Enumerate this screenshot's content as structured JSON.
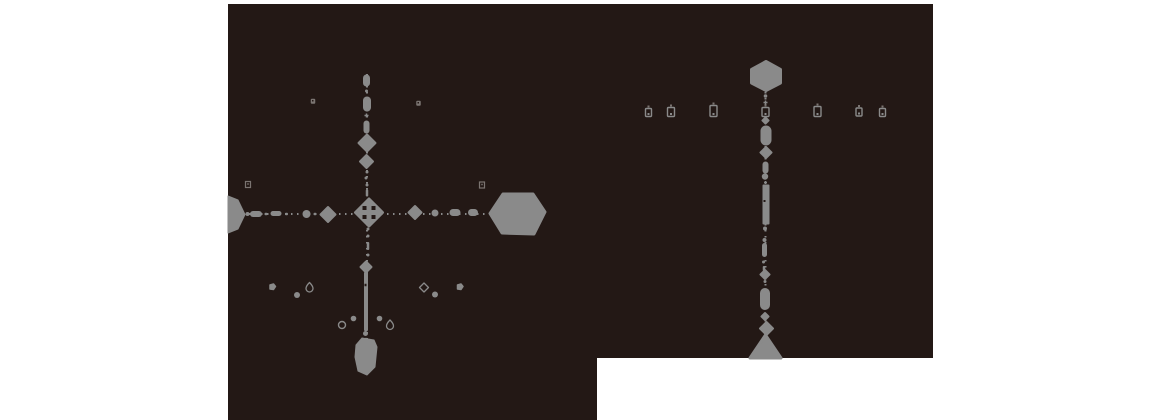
{
  "canvas": {
    "width": 1160,
    "height": 420
  },
  "colors": {
    "page_bg": "#ffffff",
    "map_bg": "#231815",
    "shape": "#8a8a8a",
    "shape_dim": "#7b7471",
    "hole": "#231815"
  },
  "map_region": {
    "name": "map-dark-region",
    "polygon": "228,4 933,4 933,358 597,358 597,420 228,420"
  },
  "dotted_paths": [
    {
      "name": "west-map-vertical-path",
      "x1": 367,
      "y1": 74,
      "x2": 367,
      "y2": 340
    },
    {
      "name": "west-map-horizontal-path",
      "x1": 231,
      "y1": 214,
      "x2": 492,
      "y2": 214
    },
    {
      "name": "east-map-vertical-path",
      "x1": 765.5,
      "y1": 92,
      "x2": 765.5,
      "y2": 338
    }
  ],
  "west_map": {
    "shapes": [
      {
        "kind": "capsule",
        "name": "waypoint-capsule",
        "x": 366.5,
        "y": 80.5,
        "w": 7,
        "h": 12
      },
      {
        "kind": "dot",
        "x": 366.5,
        "y": 91,
        "r": 1.5
      },
      {
        "kind": "capsule",
        "name": "waypoint-capsule",
        "x": 367,
        "y": 104,
        "w": 8,
        "h": 15
      },
      {
        "kind": "plus",
        "x": 366.5,
        "y": 115.5,
        "s": 4
      },
      {
        "kind": "capsule",
        "name": "waypoint-capsule",
        "x": 366.5,
        "y": 127,
        "w": 6,
        "h": 13
      },
      {
        "kind": "diamond",
        "name": "waypoint-diamond",
        "x": 367,
        "y": 143,
        "s": 17,
        "interactable": true
      },
      {
        "kind": "diamond",
        "name": "waypoint-diamond",
        "x": 366.5,
        "y": 161.5,
        "s": 13,
        "interactable": true
      },
      {
        "kind": "dot",
        "x": 367,
        "y": 172,
        "r": 1.5
      },
      {
        "kind": "dot",
        "x": 366,
        "y": 178,
        "r": 1.5
      },
      {
        "kind": "dot",
        "x": 367,
        "y": 185,
        "r": 1.5
      },
      {
        "kind": "bar",
        "x": 367,
        "y": 193,
        "w": 2.5,
        "h": 7
      },
      {
        "kind": "diamond-holes",
        "name": "map-center-node",
        "x": 369,
        "y": 212.5,
        "s": 27,
        "interactable": true
      },
      {
        "kind": "dot",
        "x": 368,
        "y": 229,
        "r": 1.5
      },
      {
        "kind": "dot",
        "x": 368,
        "y": 236,
        "r": 1.5
      },
      {
        "kind": "bar",
        "x": 368,
        "y": 246,
        "w": 2.5,
        "h": 8
      },
      {
        "kind": "dot",
        "x": 368,
        "y": 255,
        "r": 1.5
      },
      {
        "kind": "diamond",
        "name": "waypoint-diamond",
        "x": 366,
        "y": 267,
        "s": 11,
        "interactable": true
      },
      {
        "kind": "bar",
        "name": "south-route-bar",
        "x": 366,
        "y": 301.5,
        "w": 4,
        "h": 59
      },
      {
        "kind": "hole-dot",
        "x": 365.5,
        "y": 285,
        "w": 2,
        "h": 2.5
      },
      {
        "kind": "dot",
        "x": 365.5,
        "y": 333.5,
        "r": 2.5
      },
      {
        "kind": "dot",
        "x": 366,
        "y": 339,
        "r": 1.2
      },
      {
        "kind": "polygon",
        "name": "south-terminal-node",
        "interactable": true,
        "fill": true,
        "points": "356,345 362,338 374,340 377,347 375,367 367,375 358,371 355,357"
      },
      {
        "kind": "polygon",
        "name": "west-edge-node",
        "interactable": true,
        "fill": true,
        "points": "228,196 238,200 245,214.5 238,229 228,233"
      },
      {
        "kind": "dot",
        "x": 247.5,
        "y": 214,
        "r": 2
      },
      {
        "kind": "capsule-h",
        "name": "waypoint-capsule",
        "x": 256,
        "y": 214,
        "w": 12,
        "h": 6
      },
      {
        "kind": "bar-h",
        "x": 266,
        "y": 214,
        "w": 3,
        "h": 2.5
      },
      {
        "kind": "capsule-h",
        "name": "waypoint-capsule",
        "x": 276,
        "y": 213.5,
        "w": 11,
        "h": 5
      },
      {
        "kind": "bar-h",
        "x": 286.5,
        "y": 214,
        "w": 3,
        "h": 2.5
      },
      {
        "kind": "dot",
        "name": "waypoint-circle",
        "x": 306.5,
        "y": 214,
        "r": 4
      },
      {
        "kind": "bar-h",
        "x": 315,
        "y": 214,
        "w": 3,
        "h": 2.5
      },
      {
        "kind": "diamond",
        "name": "waypoint-diamond",
        "x": 328,
        "y": 214.5,
        "s": 15,
        "interactable": true
      },
      {
        "kind": "diamond",
        "name": "waypoint-diamond",
        "x": 415,
        "y": 212.5,
        "s": 13,
        "interactable": true
      },
      {
        "kind": "dot",
        "name": "waypoint-circle",
        "x": 435,
        "y": 213,
        "r": 3.5
      },
      {
        "kind": "capsule-h",
        "name": "waypoint-capsule",
        "x": 455,
        "y": 212.5,
        "w": 11,
        "h": 7
      },
      {
        "kind": "capsule-h",
        "name": "waypoint-capsule",
        "x": 473,
        "y": 212.5,
        "w": 10,
        "h": 7
      },
      {
        "kind": "polygon",
        "name": "east-terminal-node",
        "interactable": true,
        "fill": true,
        "round": true,
        "points": "490,213.5 503,194 533,194 545,212 534,234 502,233"
      },
      {
        "kind": "speck",
        "x": 313,
        "y": 101,
        "s": 4.5
      },
      {
        "kind": "speck",
        "x": 418.5,
        "y": 103,
        "s": 4.5
      },
      {
        "kind": "speck-o",
        "x": 248,
        "y": 184,
        "s": 5
      },
      {
        "kind": "speck-o",
        "x": 482,
        "y": 184.5,
        "s": 5
      },
      {
        "kind": "blob",
        "name": "pickup-icon",
        "x": 272.5,
        "y": 287,
        "s": 5.5
      },
      {
        "kind": "dot",
        "name": "pickup-dot",
        "x": 297,
        "y": 295,
        "r": 3
      },
      {
        "kind": "teardrop",
        "name": "key-icon",
        "x": 309.5,
        "y": 287
      },
      {
        "kind": "diamond-o",
        "name": "gem-outline-icon",
        "x": 424,
        "y": 287.5,
        "s": 9
      },
      {
        "kind": "dot",
        "name": "pickup-dot",
        "x": 435,
        "y": 294.5,
        "r": 3
      },
      {
        "kind": "blob",
        "name": "pickup-icon",
        "x": 460,
        "y": 287,
        "s": 5.5
      },
      {
        "kind": "circle-o",
        "name": "ring-icon",
        "x": 342,
        "y": 325,
        "r": 3.5
      },
      {
        "kind": "dot",
        "name": "pickup-dot",
        "x": 353.5,
        "y": 318.5,
        "r": 2.8
      },
      {
        "kind": "dot",
        "name": "pickup-dot",
        "x": 379.5,
        "y": 318.5,
        "r": 2.8
      },
      {
        "kind": "teardrop",
        "name": "key-icon",
        "x": 390,
        "y": 324.5
      }
    ]
  },
  "east_map": {
    "shapes": [
      {
        "kind": "polygon",
        "name": "north-terminal-node",
        "interactable": true,
        "fill": true,
        "round": true,
        "points": "766,61.5 780.5,69.5 780.5,83 766,90.5 751.5,83 751.5,69.5"
      },
      {
        "kind": "dot",
        "x": 765.5,
        "y": 96,
        "r": 1.8
      },
      {
        "kind": "plus",
        "x": 765.5,
        "y": 102.5,
        "s": 4
      },
      {
        "kind": "glyph",
        "name": "counter-glyph",
        "x": 765.5,
        "y": 112,
        "w": 7,
        "h": 9
      },
      {
        "kind": "diamond",
        "x": 765.5,
        "y": 120.5,
        "s": 6
      },
      {
        "kind": "capsule",
        "name": "waypoint-capsule",
        "x": 766,
        "y": 135.5,
        "w": 11,
        "h": 20
      },
      {
        "kind": "diamond",
        "name": "waypoint-diamond",
        "x": 766,
        "y": 152.5,
        "s": 11,
        "interactable": true
      },
      {
        "kind": "capsule",
        "name": "waypoint-capsule",
        "x": 765.5,
        "y": 167.5,
        "w": 6,
        "h": 12
      },
      {
        "kind": "dot",
        "x": 765,
        "y": 176.5,
        "r": 3.2
      },
      {
        "kind": "plus",
        "x": 765.5,
        "y": 182.5,
        "s": 3
      },
      {
        "kind": "bar",
        "name": "route-bar",
        "x": 766,
        "y": 204.5,
        "w": 7,
        "h": 40
      },
      {
        "kind": "hole-dot",
        "x": 764.5,
        "y": 201,
        "w": 2,
        "h": 2
      },
      {
        "kind": "dot",
        "x": 765,
        "y": 228.5,
        "r": 2
      },
      {
        "kind": "dot",
        "x": 764.5,
        "y": 240,
        "r": 2
      },
      {
        "kind": "capsule",
        "name": "waypoint-capsule",
        "x": 764.5,
        "y": 250,
        "w": 5,
        "h": 14
      },
      {
        "kind": "dot",
        "x": 763.5,
        "y": 262,
        "r": 1.5
      },
      {
        "kind": "bar",
        "x": 764,
        "y": 268.5,
        "w": 2.5,
        "h": 5
      },
      {
        "kind": "diamond",
        "name": "waypoint-diamond",
        "x": 765,
        "y": 274.5,
        "s": 9,
        "interactable": true
      },
      {
        "kind": "dot",
        "x": 765,
        "y": 281.5,
        "r": 1.5
      },
      {
        "kind": "capsule",
        "name": "waypoint-capsule",
        "x": 765,
        "y": 299,
        "w": 10,
        "h": 22
      },
      {
        "kind": "diamond",
        "x": 765,
        "y": 316.5,
        "s": 7
      },
      {
        "kind": "diamond",
        "name": "waypoint-diamond",
        "x": 766.5,
        "y": 328.5,
        "s": 13,
        "interactable": true
      },
      {
        "kind": "polygon",
        "name": "south-gate-node",
        "interactable": true,
        "fill": true,
        "round": true,
        "points": "765.5,335 781,358 750,358"
      },
      {
        "kind": "glyph",
        "name": "counter-glyph",
        "x": 648.5,
        "y": 112.5,
        "w": 6,
        "h": 8
      },
      {
        "kind": "glyph",
        "name": "counter-glyph",
        "x": 671,
        "y": 112,
        "w": 7,
        "h": 9
      },
      {
        "kind": "glyph",
        "name": "counter-glyph",
        "x": 713.5,
        "y": 111,
        "w": 7,
        "h": 11
      },
      {
        "kind": "glyph",
        "name": "counter-glyph",
        "x": 817.5,
        "y": 111.5,
        "w": 7,
        "h": 10
      },
      {
        "kind": "glyph",
        "name": "counter-glyph",
        "x": 859,
        "y": 112,
        "w": 6,
        "h": 8
      },
      {
        "kind": "glyph",
        "name": "counter-glyph",
        "x": 882.5,
        "y": 112.5,
        "w": 6,
        "h": 8
      }
    ]
  }
}
